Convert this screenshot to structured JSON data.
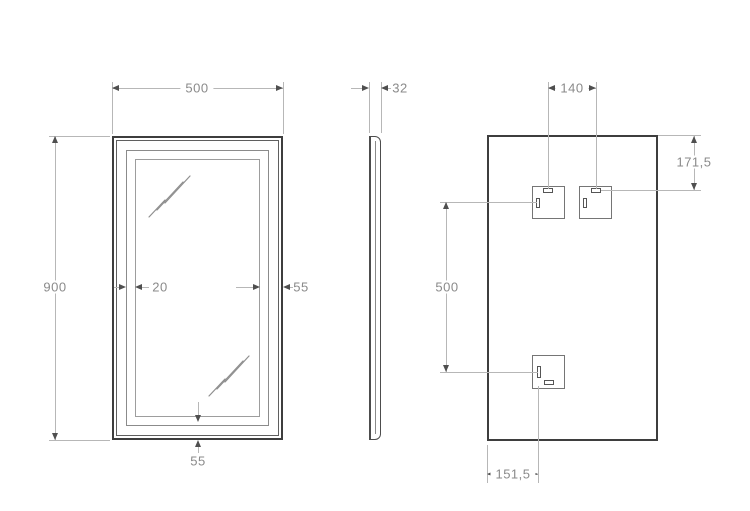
{
  "dimensions": {
    "front": {
      "width": "500",
      "height": "900",
      "led_frame_offset": "20",
      "frame_edge_right": "55",
      "frame_edge_bottom": "55"
    },
    "side": {
      "thickness": "32"
    },
    "back": {
      "bracket_spacing": "140",
      "bracket_top_offset": "171,5",
      "bracket_vertical_spacing": "500",
      "bracket_bottom_offset": "151,5"
    }
  }
}
